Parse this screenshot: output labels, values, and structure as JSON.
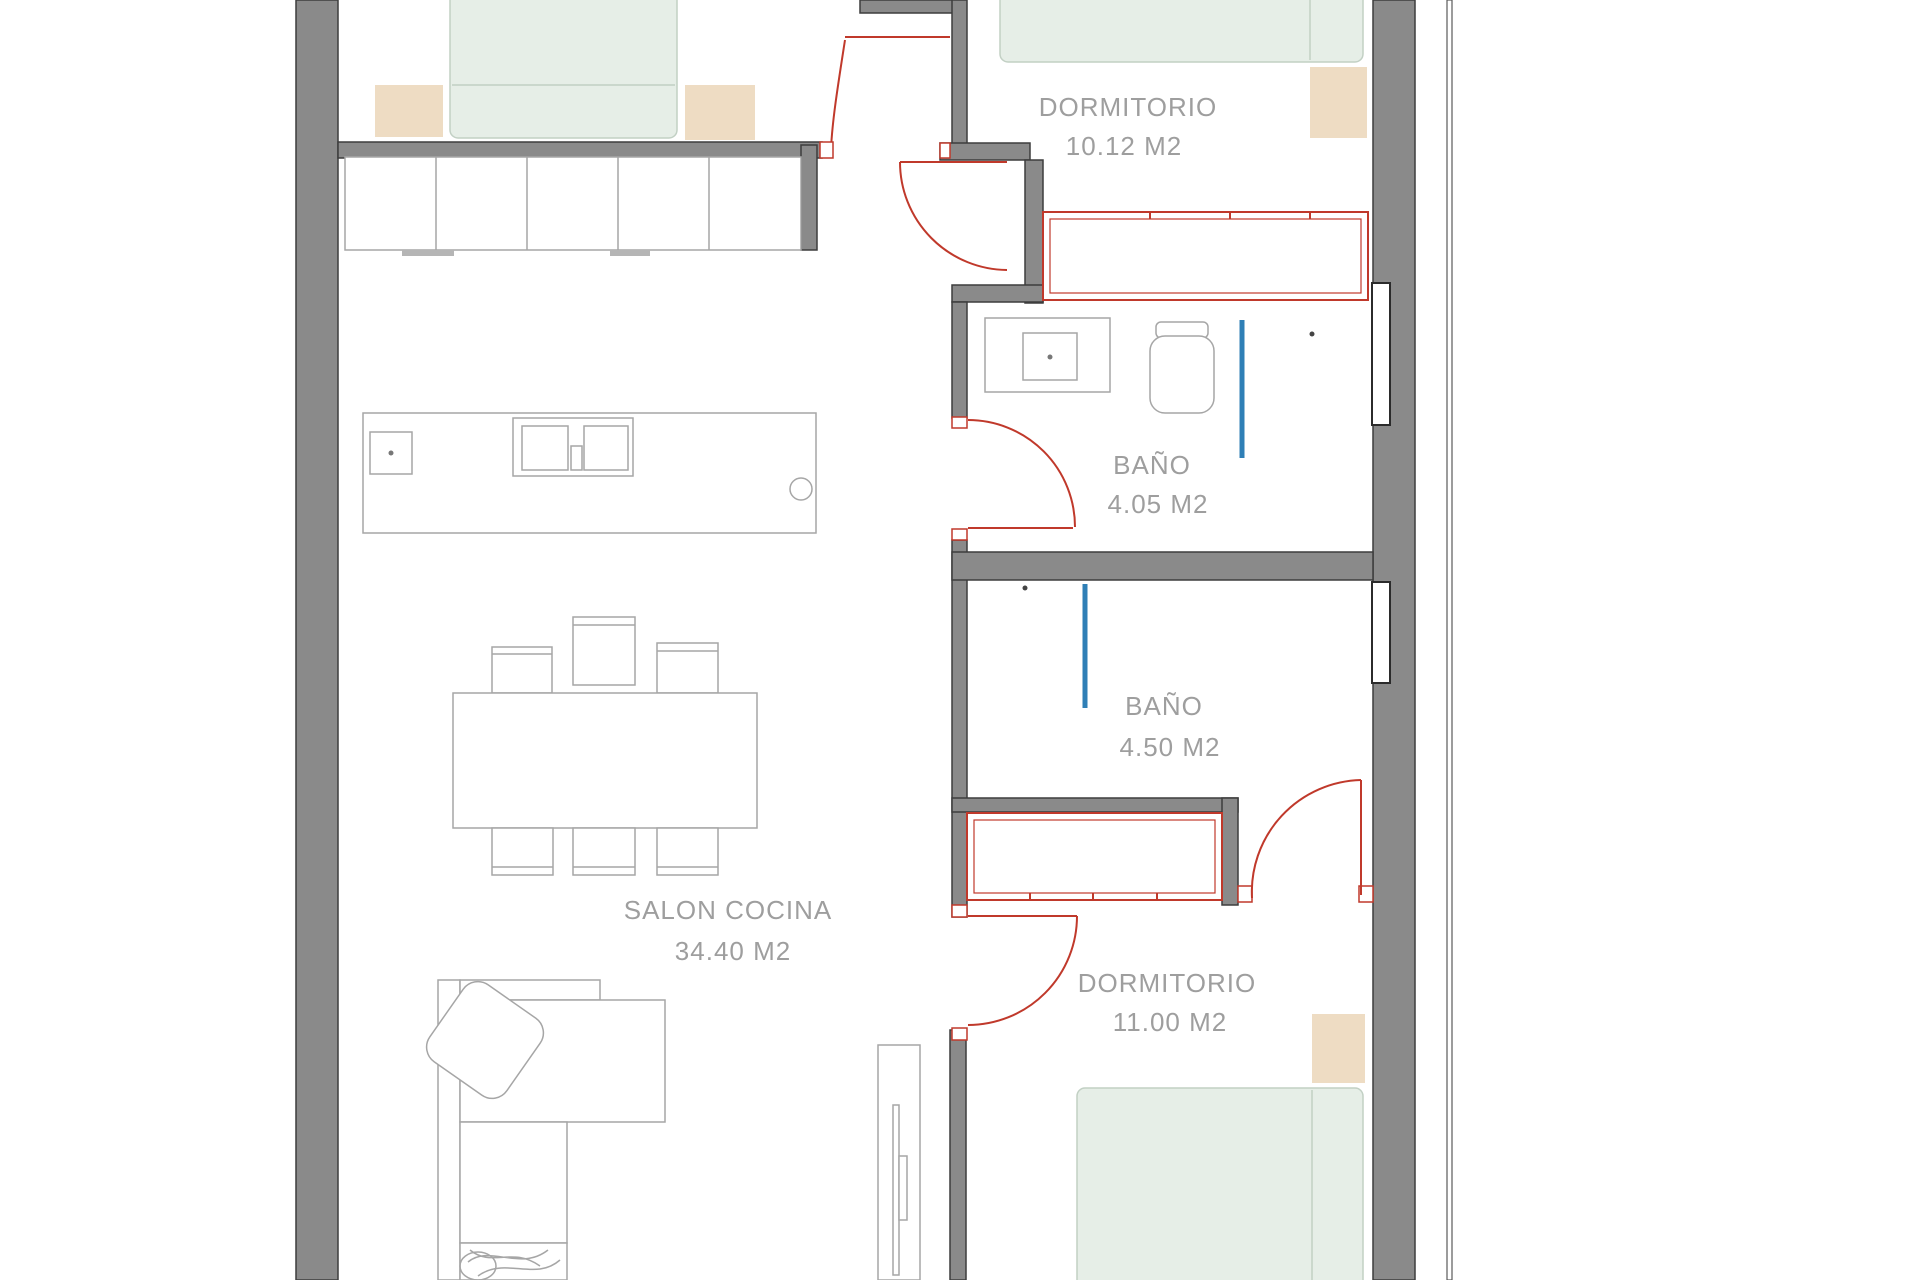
{
  "page": {
    "background": "#ffffff",
    "description": "residential apartment floor plan"
  },
  "colors": {
    "wall_gray": "#8a8a8a",
    "door_red": "#c0392b",
    "shower_blue": "#2f7fb6",
    "bed_green": "#e6eee7",
    "wood_beige": "#eedcc3",
    "label_gray": "#9e9e9e"
  },
  "rooms": [
    {
      "id": "dormitorio-1",
      "name": "DORMITORIO",
      "area": "10.12 M2"
    },
    {
      "id": "bano-1",
      "name": "BAÑO",
      "area": "4.05 M2"
    },
    {
      "id": "bano-2",
      "name": "BAÑO",
      "area": "4.50 M2"
    },
    {
      "id": "salon-cocina",
      "name": "SALON COCINA",
      "area": "34.40 M2"
    },
    {
      "id": "dormitorio-2",
      "name": "DORMITORIO",
      "area": "11.00 M2"
    }
  ]
}
